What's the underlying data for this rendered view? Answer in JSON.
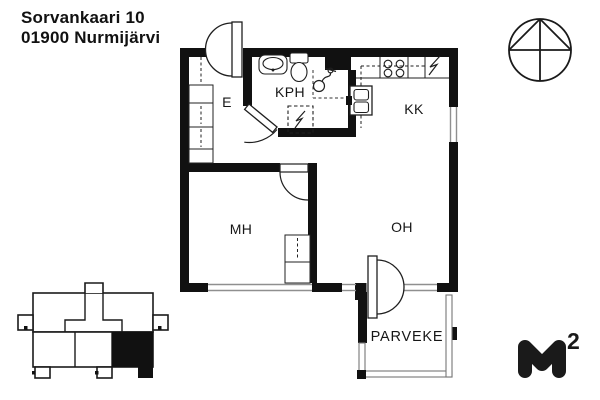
{
  "header": {
    "address_line1": "Sorvankaari 10",
    "address_line2": "01900 Nurmijärvi"
  },
  "rooms": {
    "entry": "E",
    "bathroom": "KPH",
    "kitchenette": "KK",
    "bedroom": "MH",
    "living_room": "OH",
    "balcony": "PARVEKE"
  },
  "logo": {
    "letter": "M",
    "exponent": "2"
  },
  "icons": {
    "compass": "north-indicator-circle",
    "building_locator": "apartment-location-highlight",
    "lightning_symbol": "appliance-reservation",
    "shower": "shower-head",
    "toilet": "wc-seat",
    "washbasin": "sink-basin"
  },
  "colors": {
    "wall": "#111111",
    "line": "#1f1f1f",
    "window_line": "#8f8f8f",
    "railing_line": "#777777",
    "background": "#ffffff",
    "highlight_unit": "#111111"
  }
}
